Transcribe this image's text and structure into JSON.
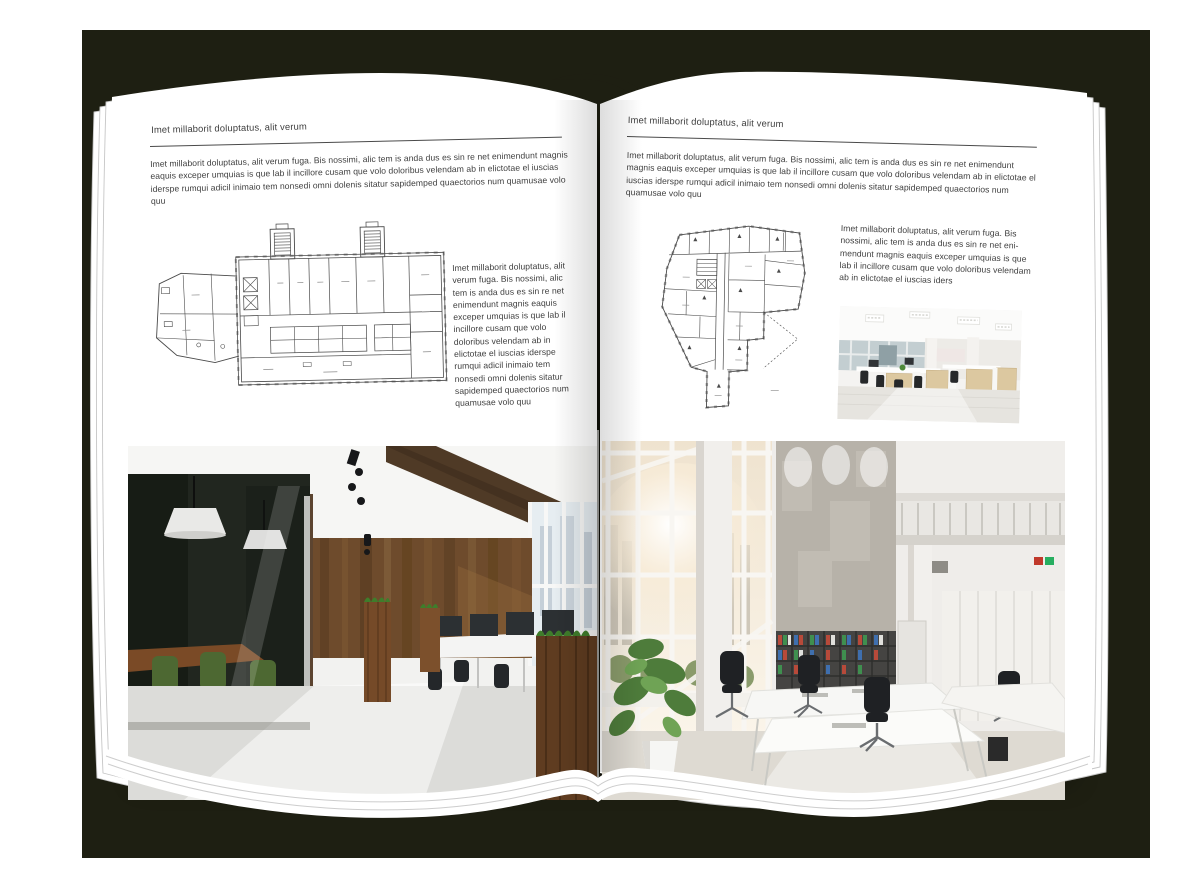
{
  "colors": {
    "backdrop": "#1e1f12",
    "page": "#ffffff",
    "text": "#3e3e3e",
    "rule": "#4a4a4a",
    "plan_ink": "#4a4a4a"
  },
  "left_page": {
    "header": "Imet millaborit doluptatus, alit verum",
    "intro": "Imet millaborit doluptatus, alit verum fuga. Bis nossimi, alic tem is anda dus es sin re net enimendunt magnis eaquis exceper umquias is que lab il incillore cusam que volo doloribus velendam ab in elictotae el iuscias iderspe rumqui adicil inimaio tem nonsedi omni dolenis sitatur sapidemped quaectorios num quamusae volo quu",
    "side_paragraph": "Imet millaborit doluptatus, alit verum fuga. Bis nossimi, alic tem is anda dus es sin re net enimendunt magnis eaquis exceper umquias is que lab il incillore cusam que volo doloribus velendam ab in elictotae el iuscias iderspe rumqui adicil inimaio tem nonsedi omni dolenis sitatur sapidemped quaectorios num quamusae volo quu"
  },
  "right_page": {
    "header": "Imet millaborit doluptatus, alit verum",
    "intro": "Imet millaborit doluptatus, alit verum fuga. Bis nossimi, alic tem is anda dus es sin re net enimendunt magnis eaquis exceper umquias is que lab il incillore cusam que volo doloribus velendam ab in elictotae el iuscias iderspe rumqui adicil inimaio tem nonsedi omni dolenis sitatur sapidemped quaectorios num quamusae volo quu",
    "side_paragraph": "Imet millaborit doluptatus, alit verum fuga. Bis nossimi, alic tem is anda dus es sin re net eni­mendunt magnis eaquis exceper umquias is que lab il incillore cusam que volo doloribus velendam ab in elictotae el iuscias iders"
  }
}
